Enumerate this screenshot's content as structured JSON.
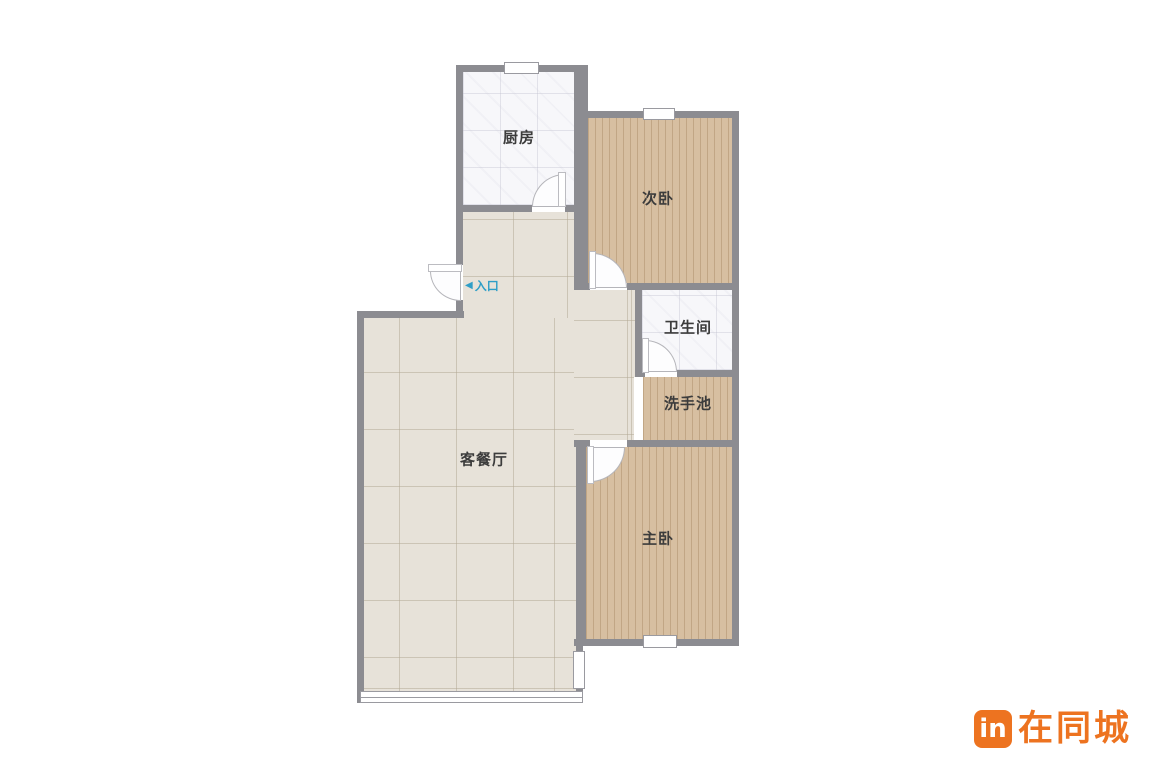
{
  "floorplan": {
    "rooms": [
      {
        "id": "kitchen",
        "label": "厨房",
        "floor": "white-tile"
      },
      {
        "id": "second-bedroom",
        "label": "次卧",
        "floor": "wood"
      },
      {
        "id": "bathroom",
        "label": "卫生间",
        "floor": "white-tile"
      },
      {
        "id": "washbasin",
        "label": "洗手池",
        "floor": "wood"
      },
      {
        "id": "master-bedroom",
        "label": "主卧",
        "floor": "wood"
      },
      {
        "id": "living-dining",
        "label": "客餐厅",
        "floor": "beige-tile"
      }
    ],
    "entrance": {
      "arrow_glyph": "◀",
      "label": "入口",
      "color": "#2f9ec7"
    },
    "colors": {
      "wall": "#8c8c91",
      "wood_floor": "#d7bfa1",
      "white_tile_floor": "#f7f7fa",
      "living_floor": "#e7e2d9",
      "label_text": "#3c3c3c"
    }
  },
  "watermark": {
    "logo_badge_text": "in",
    "brand_text": "在同城",
    "brand_color": "#ed7320"
  }
}
